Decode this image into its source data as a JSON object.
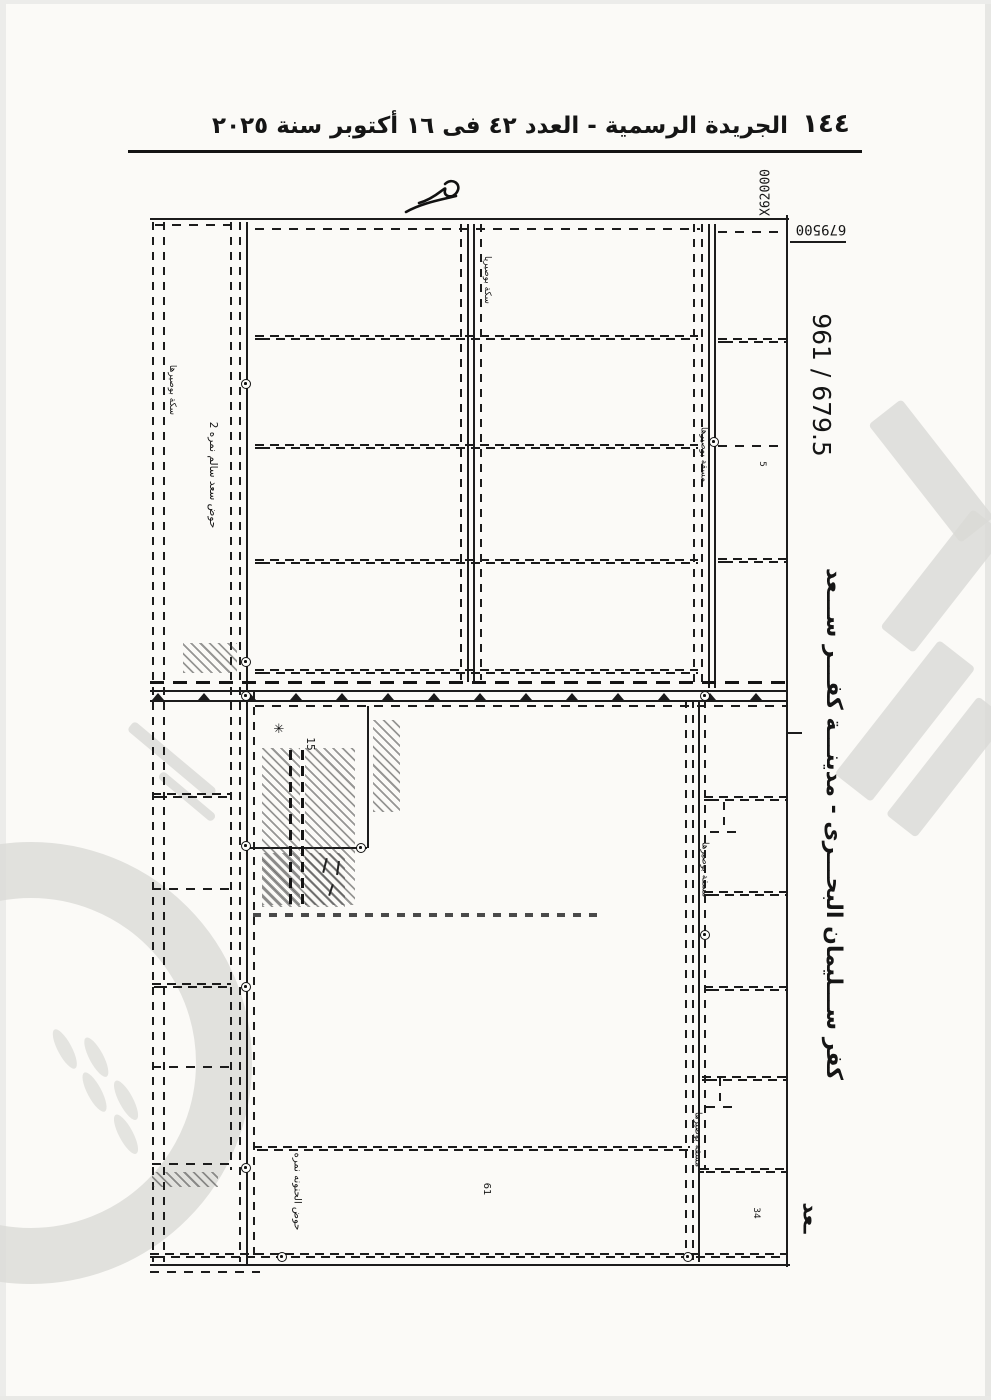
{
  "page": {
    "number": "١٤٤",
    "header_title": "الجريدة الرسمية - العدد ٤٢ فى ١٦ أكتوبر سنة ٢٠٢٥"
  },
  "map": {
    "sheet_ref": "961 / 679.5",
    "grid_x": "X62000",
    "grid_y": "679500",
    "district_title": "كفر ســـليمان البحـــرى - مدينـــة كفـــر ســـعد",
    "district_title_fragment": "ـعد",
    "basins": {
      "top": "حوض سعد سالم نمره 2",
      "bottom": "حوض الحنونه نمره"
    },
    "roads": {
      "track_left": "سكة بوصيرها",
      "track_center": "سكة بوصيريا",
      "canal": "مسقة بوصيرها"
    },
    "plot_numbers": {
      "p15": "15",
      "p61": "61",
      "p34": "34",
      "p5": "5"
    },
    "symbols": {
      "star_mark": "✳"
    }
  },
  "colors": {
    "ink": "#1c1c1c",
    "paper": "#fbfaf7",
    "watermark": "#dadad6"
  }
}
